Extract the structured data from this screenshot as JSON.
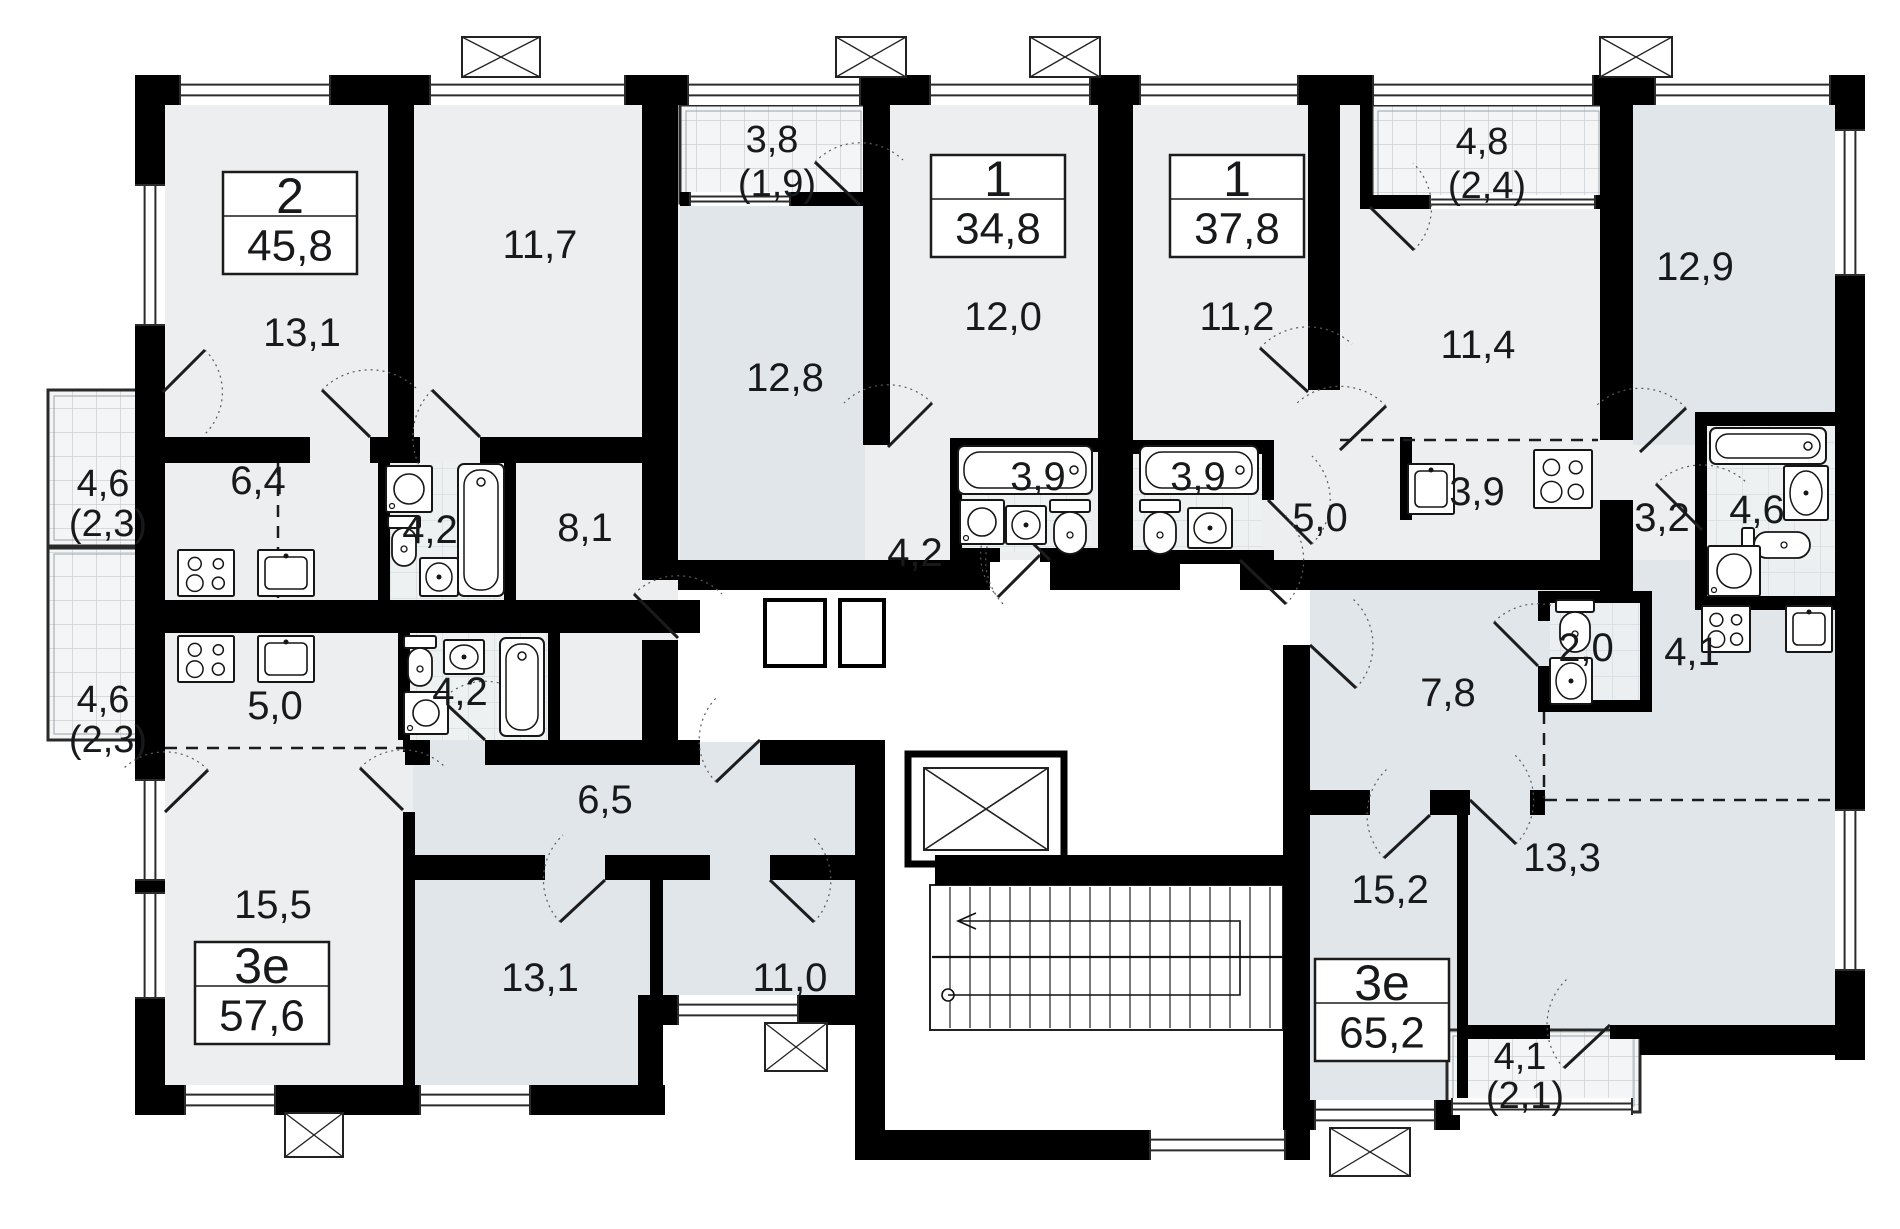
{
  "plan": {
    "canvas_width": 1900,
    "canvas_height": 1229,
    "wall_color": "#000000",
    "room_fill": "#eceeef",
    "room_fill_dark": "#e1e6ea",
    "apartments": [
      {
        "id": "apt-2rooms-45-8",
        "type_label": "2",
        "area_label": "45,8",
        "box_cx": 290,
        "box_cy": 223,
        "rooms": [
          {
            "name": "living-room",
            "text": "13,1",
            "x": 302,
            "y": 333
          },
          {
            "name": "bedroom",
            "text": "11,7",
            "x": 540,
            "y": 245
          },
          {
            "name": "kitchen",
            "text": "6,4",
            "x": 258,
            "y": 481
          },
          {
            "name": "bathroom",
            "text": "4,2",
            "x": 430,
            "y": 530
          },
          {
            "name": "hallway",
            "text": "8,1",
            "x": 585,
            "y": 528
          }
        ]
      },
      {
        "id": "apt-1room-34-8",
        "type_label": "1",
        "area_label": "34,8",
        "box_cx": 998,
        "box_cy": 206,
        "rooms": [
          {
            "name": "kitchen-living",
            "text": "12,8",
            "x": 785,
            "y": 378
          },
          {
            "name": "bedroom",
            "text": "12,0",
            "x": 1003,
            "y": 317
          },
          {
            "name": "bathroom",
            "text": "3,9",
            "x": 1038,
            "y": 477
          },
          {
            "name": "hallway",
            "text": "4,2",
            "x": 915,
            "y": 553
          }
        ]
      },
      {
        "id": "apt-1room-37-8",
        "type_label": "1",
        "area_label": "37,8",
        "box_cx": 1237,
        "box_cy": 206,
        "rooms": [
          {
            "name": "bedroom",
            "text": "11,2",
            "x": 1237,
            "y": 317
          },
          {
            "name": "bathroom",
            "text": "3,9",
            "x": 1198,
            "y": 477
          },
          {
            "name": "hallway",
            "text": "5,0",
            "x": 1320,
            "y": 518
          },
          {
            "name": "kitchen-living",
            "text": "11,4",
            "x": 1478,
            "y": 345
          },
          {
            "name": "kitchen",
            "text": "3,9",
            "x": 1477,
            "y": 492
          }
        ]
      },
      {
        "id": "apt-3e-65-2",
        "type_label": "3е",
        "area_label": "65,2",
        "box_cx": 1382,
        "box_cy": 1010,
        "rooms": [
          {
            "name": "bedroom",
            "text": "12,9",
            "x": 1695,
            "y": 267
          },
          {
            "name": "corridor",
            "text": "3,2",
            "x": 1662,
            "y": 518
          },
          {
            "name": "bathroom",
            "text": "4,6",
            "x": 1757,
            "y": 510
          },
          {
            "name": "wc",
            "text": "2,0",
            "x": 1586,
            "y": 648
          },
          {
            "name": "kitchen",
            "text": "4,1",
            "x": 1692,
            "y": 652
          },
          {
            "name": "hallway",
            "text": "7,8",
            "x": 1448,
            "y": 693
          },
          {
            "name": "living-room",
            "text": "15,2",
            "x": 1390,
            "y": 890
          },
          {
            "name": "bedroom-2",
            "text": "13,3",
            "x": 1562,
            "y": 858
          }
        ]
      },
      {
        "id": "apt-3e-57-6",
        "type_label": "3е",
        "area_label": "57,6",
        "box_cx": 262,
        "box_cy": 993,
        "rooms": [
          {
            "name": "kitchen",
            "text": "5,0",
            "x": 275,
            "y": 706
          },
          {
            "name": "bathroom",
            "text": "4,2",
            "x": 460,
            "y": 692
          },
          {
            "name": "corridor",
            "text": "6,5",
            "x": 605,
            "y": 800
          },
          {
            "name": "living-room",
            "text": "15,5",
            "x": 273,
            "y": 905
          },
          {
            "name": "bedroom",
            "text": "13,1",
            "x": 540,
            "y": 978
          },
          {
            "name": "bedroom-2",
            "text": "11,0",
            "x": 790,
            "y": 978
          }
        ]
      }
    ],
    "balconies": [
      {
        "id": "balcony-left-upper",
        "area_label": "4,6",
        "reduced_label": "(2,3)",
        "x": 103,
        "y1": 484,
        "y2": 524
      },
      {
        "id": "balcony-left-lower",
        "area_label": "4,6",
        "reduced_label": "(2,3)",
        "x": 103,
        "y1": 700,
        "y2": 740
      },
      {
        "id": "balcony-top",
        "area_label": "3,8",
        "reduced_label": "(1,9)",
        "x": 772,
        "y1": 140,
        "y2": 184
      },
      {
        "id": "balcony-top-right",
        "area_label": "4,8",
        "reduced_label": "(2,4)",
        "x": 1482,
        "y1": 142,
        "y2": 186
      },
      {
        "id": "balcony-bottom-right",
        "area_label": "4,1",
        "reduced_label": "(2,1)",
        "x": 1520,
        "y1": 1057,
        "y2": 1096
      }
    ]
  }
}
